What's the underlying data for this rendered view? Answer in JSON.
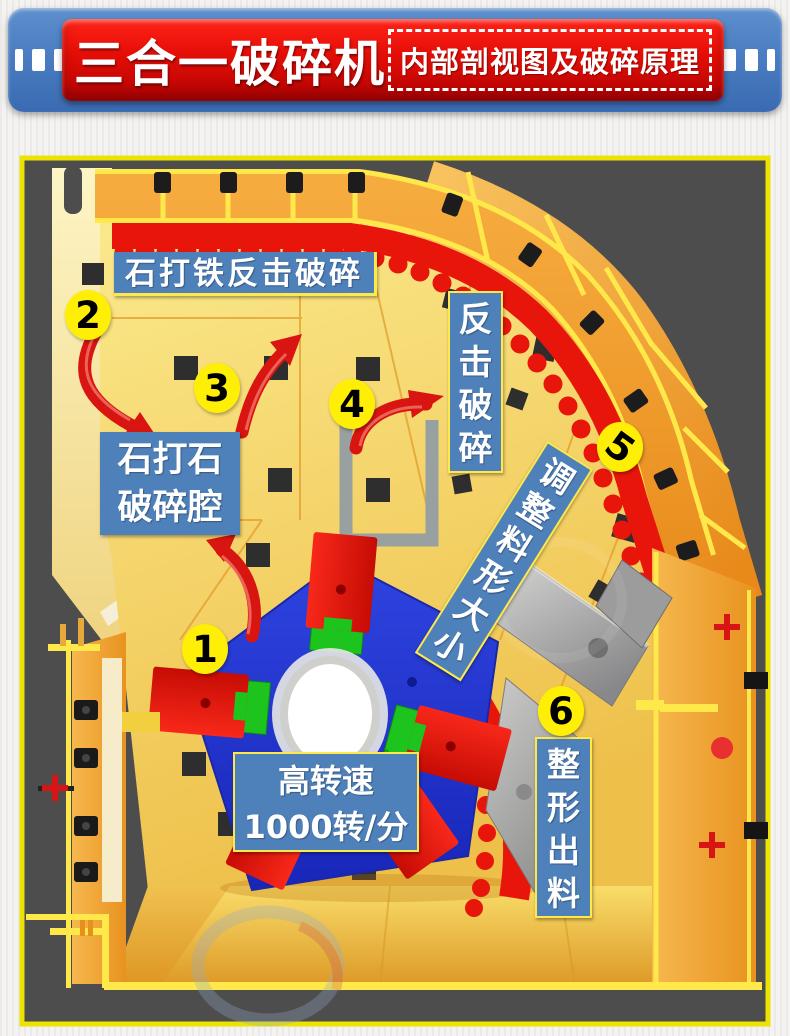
{
  "header": {
    "title": "三合一破碎机",
    "subtitle": "内部剖视图及破碎原理"
  },
  "diagram": {
    "markers": [
      "1",
      "2",
      "3",
      "4",
      "5",
      "6"
    ],
    "labels": {
      "stone_iron_impact": "石打铁反击破碎",
      "stone_stone_line1": "石打石",
      "stone_stone_line2": "破碎腔",
      "impact_crush": "反击破碎",
      "adjust_size": "调整料形大小",
      "speed_line1": "高转速",
      "speed_line2": "1000转/分",
      "shaping_discharge": "整形出料"
    },
    "colors": {
      "panel_bg": "#4d4d4d",
      "panel_border": "#ece400",
      "label_bg": "#4e80ba",
      "marker_bg": "#ffee06",
      "machine_yellow": "#f7e070",
      "casing_orange": "#f0a030",
      "liner_red": "#e8150a",
      "rotor_blue": "#2a3fd8",
      "hammer_green": "#1ec41e",
      "banner_blue": "#4a7dc2",
      "banner_red": "#e30d06"
    }
  }
}
